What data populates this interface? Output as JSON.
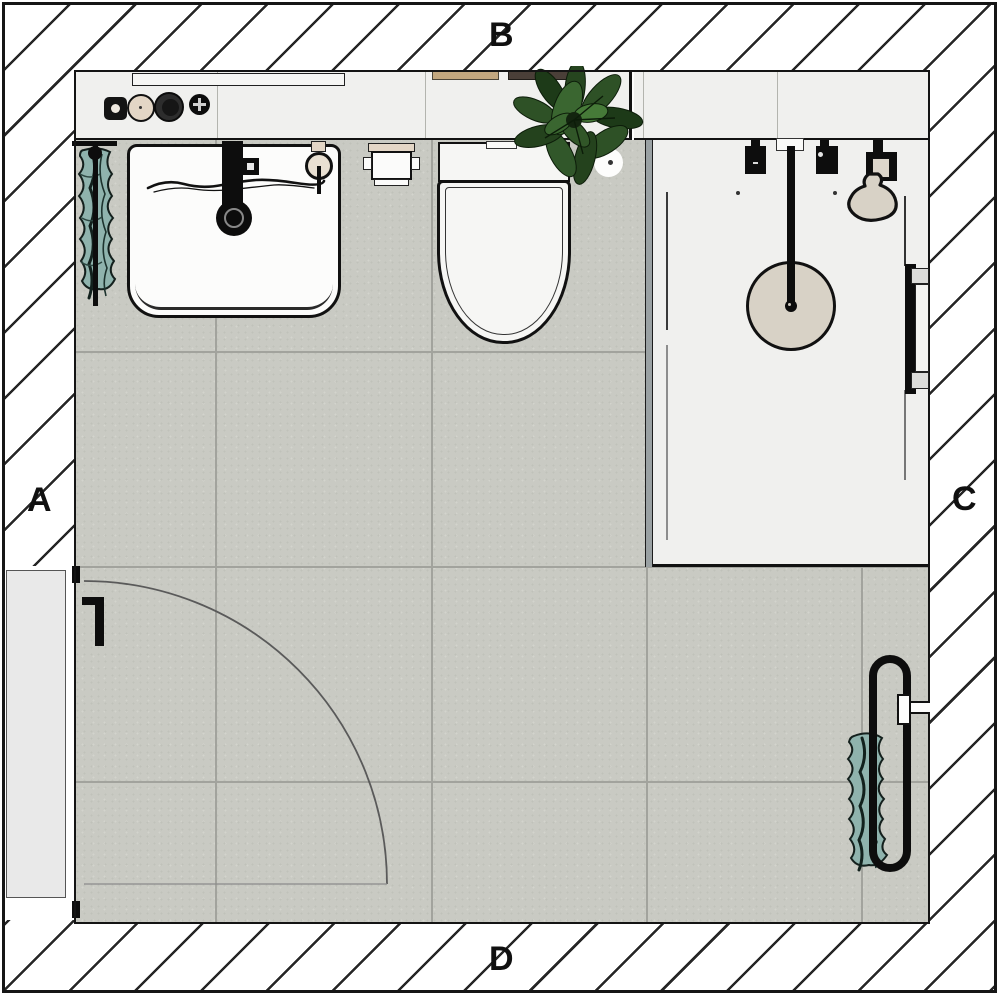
{
  "diagram": {
    "type": "bathroom floor plan (top view)",
    "wall_labels": {
      "left": "A",
      "top": "B",
      "right": "C",
      "bottom": "D"
    },
    "fixtures": [
      "vanity-counter",
      "counter-accessories",
      "washbasin",
      "basin-faucet",
      "basin-drain",
      "towel-ring",
      "wall-towel-left",
      "toilet-paper-holder",
      "toilet",
      "potted-plant",
      "ceiling-spot",
      "shower-counter",
      "shower-glass-panel",
      "shower-tray",
      "shower-valves",
      "rain-shower-head",
      "hand-shower",
      "shower-door-handle",
      "towel-radiator-right",
      "wall-towel-right",
      "entry-door",
      "door-swing-arc"
    ],
    "colors": {
      "wall_hatch_line": "#262626",
      "floor_tile": "#c9cac3",
      "tile_joint": "#a2a39d",
      "counter": "#f0f0ee",
      "shower_tray": "#f0f0ee",
      "fixture_white": "#fbfbfa",
      "outline": "#111111",
      "towel_teal": "#8fb3ad",
      "plant_green": "#2e5126",
      "shower_head_beige": "#d8d2c6",
      "accessory_beige": "#e3d6c6",
      "item_tan": "#c2a77f",
      "item_brown": "#4a3f38",
      "door_leaf": "#e9e9e9"
    }
  }
}
